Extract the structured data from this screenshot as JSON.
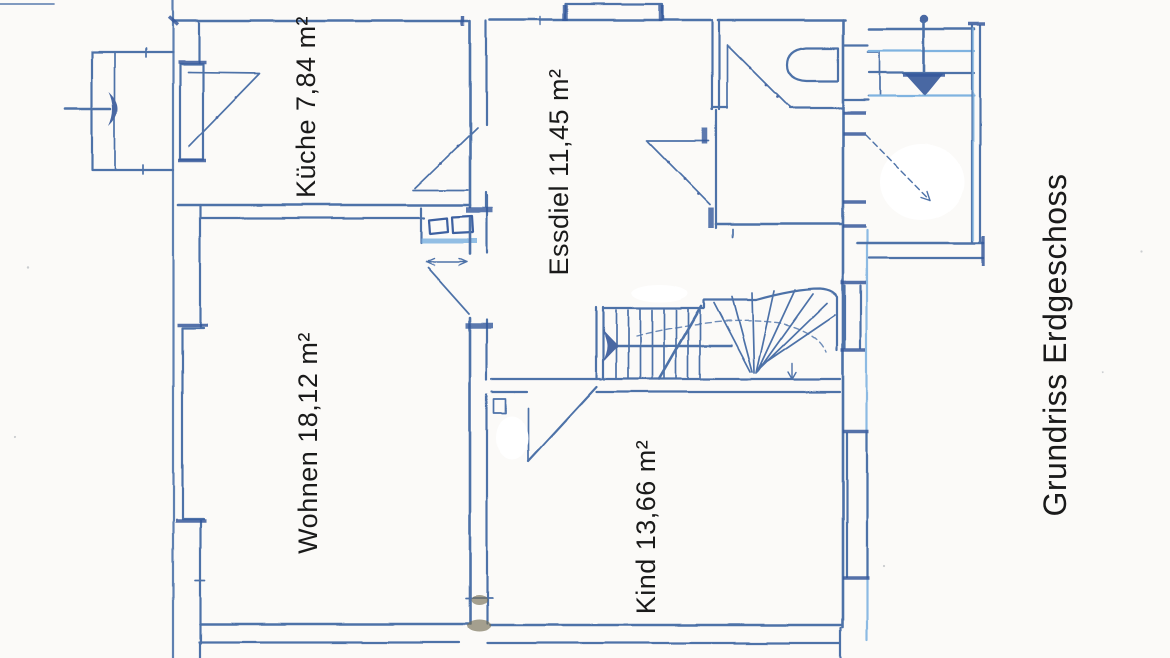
{
  "title": "Grundriss Erdgeschoss",
  "rooms": [
    {
      "name": "Küche",
      "area_m2": "7,84",
      "label": "Küche 7,84 m²"
    },
    {
      "name": "Essdiel",
      "area_m2": "11,45",
      "label": "Essdiel 11,45 m²"
    },
    {
      "name": "Wohnen",
      "area_m2": "18,12",
      "label": "Wohnen 18,12 m²"
    },
    {
      "name": "Kind",
      "area_m2": "13,66",
      "label": "Kind 13,66 m²"
    }
  ],
  "symbols": {
    "left_entrance": "entrance-arrow-with-steps",
    "top_right_entrance": "entrance-arrow-with-steps",
    "staircase": "winder-staircase-to-upper-floor",
    "wc": "toilet-symbol",
    "doors": "door-swing-symbols",
    "windows": "double-line-window-symbols"
  },
  "colors": {
    "ink": "#4e72a8",
    "ink_dark": "#35589c",
    "ink_light": "#7fb3e0",
    "paper": "#fbfaf8",
    "label_text": "#1a1a1a"
  }
}
